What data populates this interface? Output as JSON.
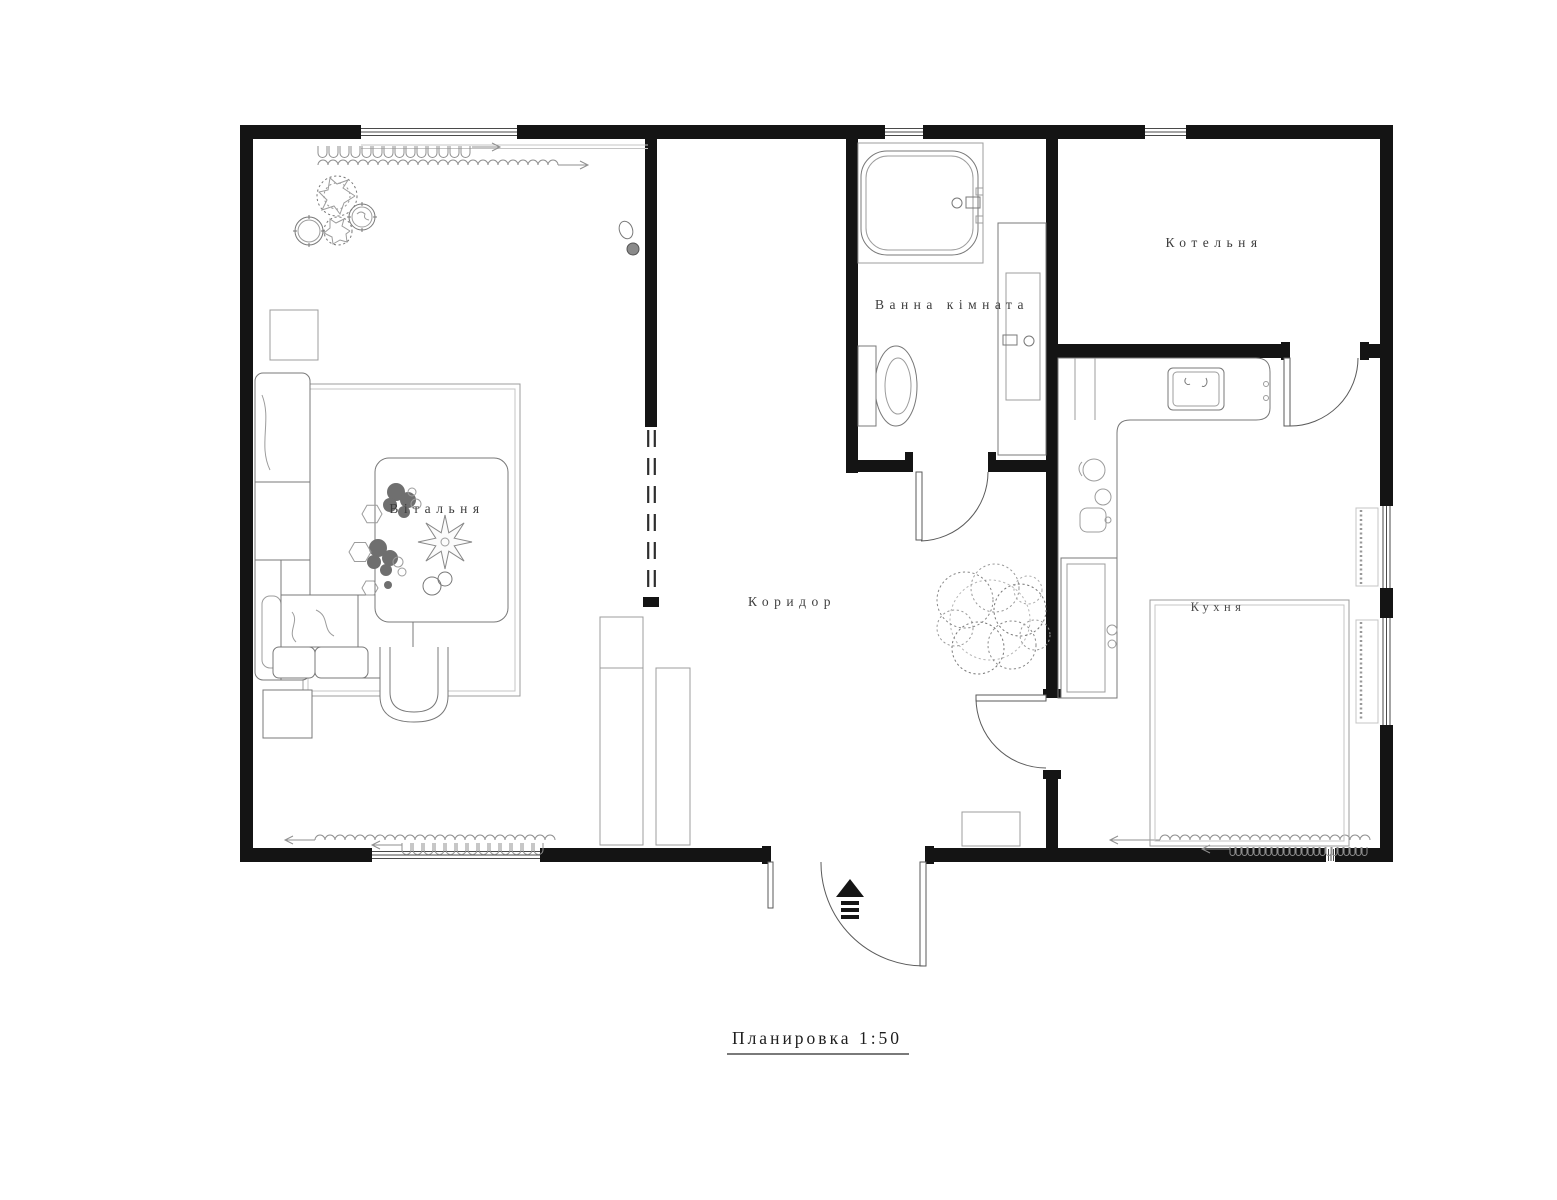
{
  "title": {
    "text": "Планировка 1:50"
  },
  "rooms": {
    "living": {
      "label": "Вітальня"
    },
    "bathroom": {
      "label": "Ванна кімната"
    },
    "boiler": {
      "label": "Котельня"
    },
    "corridor": {
      "label": "Коридор"
    },
    "kitchen": {
      "label": "Кухня"
    }
  },
  "icons": {
    "entrance_arrow": "entrance-direction-arrow",
    "radiator": "radiator-squiggle",
    "door_swing": "door-swing-arc"
  },
  "colors": {
    "background": "#ffffff",
    "walls": "#141414",
    "doors": "#5a5a5a",
    "furniture": "#787878",
    "light_lines": "#9c9c9c",
    "text": "#3d3d3d"
  }
}
